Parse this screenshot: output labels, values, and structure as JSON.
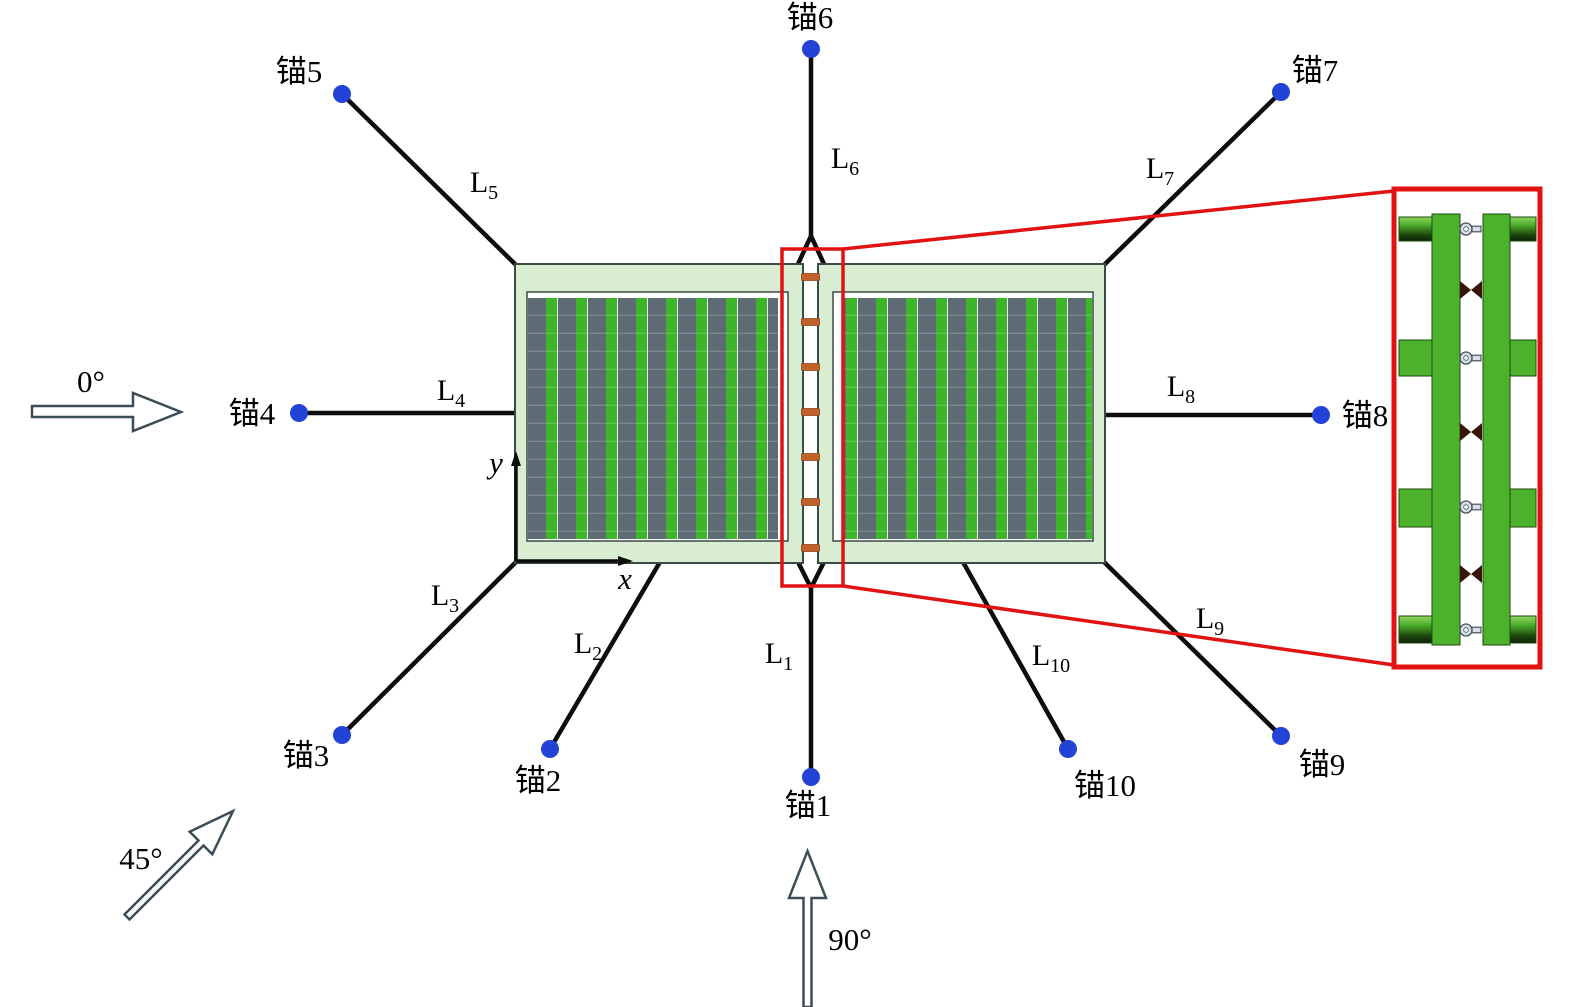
{
  "figure_type": "mooring-layout-diagram",
  "anchors": [
    {
      "label": "锚1"
    },
    {
      "label": "锚2"
    },
    {
      "label": "锚3"
    },
    {
      "label": "锚4"
    },
    {
      "label": "锚5"
    },
    {
      "label": "锚6"
    },
    {
      "label": "锚7"
    },
    {
      "label": "锚8"
    },
    {
      "label": "锚9"
    },
    {
      "label": "锚10"
    }
  ],
  "lines": [
    {
      "main": "L",
      "sub": "1"
    },
    {
      "main": "L",
      "sub": "2"
    },
    {
      "main": "L",
      "sub": "3"
    },
    {
      "main": "L",
      "sub": "4"
    },
    {
      "main": "L",
      "sub": "5"
    },
    {
      "main": "L",
      "sub": "6"
    },
    {
      "main": "L",
      "sub": "7"
    },
    {
      "main": "L",
      "sub": "8"
    },
    {
      "main": "L",
      "sub": "9"
    },
    {
      "main": "L",
      "sub": "10"
    }
  ],
  "axes": {
    "x_label": "x",
    "y_label": "y"
  },
  "directions": {
    "deg0": "0°",
    "deg45": "45°",
    "deg90": "90°"
  },
  "colors": {
    "anchor_blue": "#2342d6",
    "mooring_black": "#0d0d0d",
    "frame_green": "#d9edd3",
    "panel_gray": "#5c6b74",
    "panel_green": "#3cb528",
    "connector_orange": "#c2622a",
    "highlight_red": "#e01212",
    "detail_green": "#4cb22c",
    "bowtie_brown": "#3a1505",
    "shackle_gray": "#d6dfe6"
  }
}
